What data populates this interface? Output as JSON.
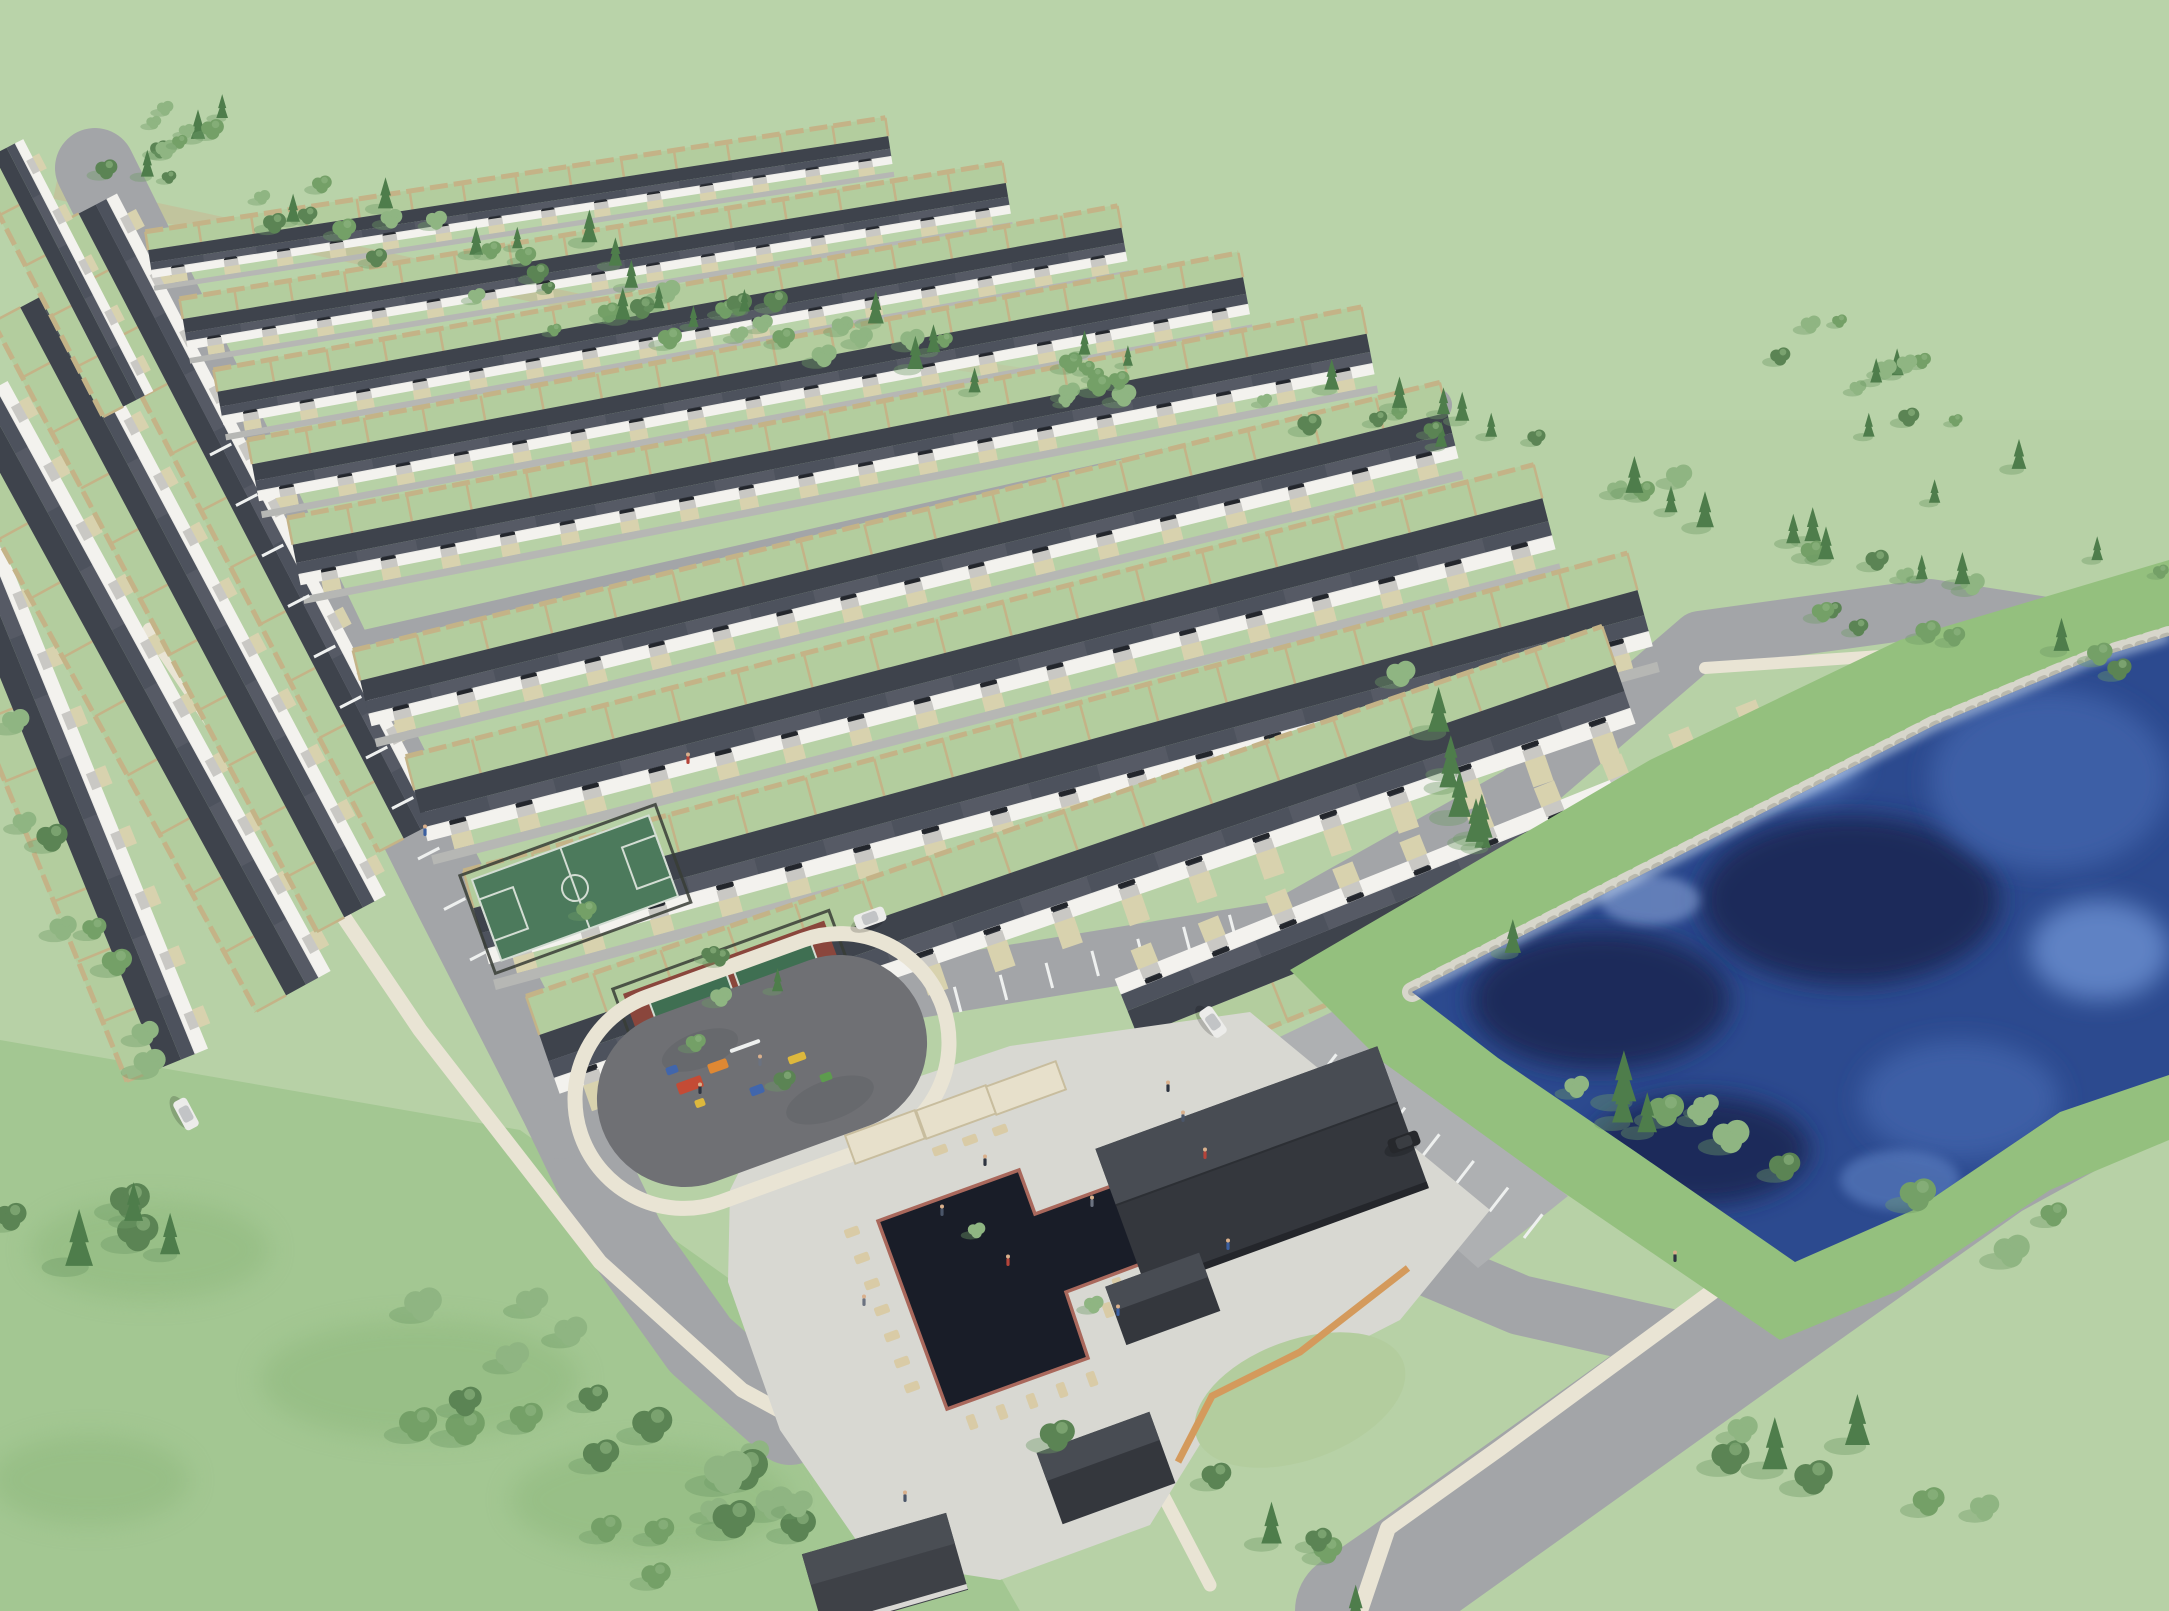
{
  "meta": {
    "description": "Aerial 3D architectural rendering of a planned townhome community with rows of dark-roofed townhouses, detached garage rows, an amenity core (sport court, pickleball court, playground, swimming pool, clubhouse, parking), a deep blue retention pond, perimeter roads, tree lines and open meadows",
    "visible_text": "none"
  },
  "colors": {
    "field": "#b7d1a6",
    "fieldFar": "#bcd5ab",
    "meadow": "#a3c792",
    "meadowShadow": "#8db77c",
    "yard": "#b3cd9e",
    "dirt": "#c8b894",
    "treeDark": "#5b8454",
    "treeMid": "#74a067",
    "treeLight": "#8fb582",
    "pine": "#4e7d4b",
    "treeShadow": "#6f9a66",
    "roof": "#4d525d",
    "roofDark": "#3e434c",
    "wall": "#f3f2ee",
    "window": "#2e323a",
    "garageDoor": "#c9c8c4",
    "road": "#a3a5a8",
    "roadL": "#aeb0b2",
    "lane": "#b6b7b4",
    "stripe": "#eef0ef",
    "walk": "#e9e4d4",
    "driveway": "#d8d2ae",
    "fence": "#c4b387",
    "pondGrass": "#94c07e",
    "pondDeep": "#2c4a8f",
    "pondDark": "#1b2c5a",
    "pondMid": "#3c5ea6",
    "pondLight": "#5f82c4",
    "pondPale": "#8fa9da",
    "rock": "#d7d6cb",
    "rockDark": "#b9b8ad",
    "pool": "#191d28",
    "coping": "#a9685c",
    "plaza": "#d8d8d2",
    "chair": "#d9cba6",
    "pergola": "#e7e0cb",
    "clubRoof": "#34373d",
    "clubRoofLight": "#484c53",
    "orangeFence": "#d49a5c",
    "courtGreen": "#4c7a5c",
    "courtLine": "#d3ddd3",
    "pickleMaroon": "#8a463c",
    "pickleGreen": "#3f6f52",
    "playSurface": "#6f7074",
    "playRed": "#c44b35",
    "playOrange": "#df8833",
    "playYellow": "#ddb83d",
    "playBlue": "#4166ac",
    "playGreen": "#5d9b4e",
    "carWhite": "#ececea",
    "carBlack": "#26282c"
  },
  "scene": {
    "housing_rows": [
      [
        150,
        262,
        890,
        148,
        30
      ],
      [
        185,
        332,
        1008,
        196,
        33
      ],
      [
        220,
        406,
        1124,
        242,
        36
      ],
      [
        255,
        480,
        1246,
        293,
        40
      ],
      [
        296,
        562,
        1370,
        351,
        44
      ],
      [
        365,
        700,
        1452,
        432,
        50
      ],
      [
        420,
        812,
        1548,
        520,
        56
      ],
      [
        480,
        932,
        1644,
        614,
        62
      ],
      [
        548,
        1060,
        1624,
        690,
        66
      ]
    ],
    "lakeside_rows": [
      [
        1128,
        1012,
        1800,
        742,
        66,
        -1
      ]
    ],
    "garage_rows": [
      [
        -40,
        520,
        180,
        1060,
        56,
        -1
      ],
      [
        -18,
        395,
        305,
        985,
        54,
        -1
      ],
      [
        38,
        298,
        362,
        908,
        50,
        -1
      ],
      [
        95,
        205,
        420,
        830,
        46,
        -1
      ],
      [
        6,
        148,
        136,
        400,
        36,
        -1
      ]
    ],
    "tree_bands": [
      {
        "x1": 40,
        "y1": 120,
        "x2": 600,
        "y2": 300,
        "spread": 150,
        "count": 32,
        "s1": 0.45,
        "s2": 0.8,
        "pine": 0.25
      },
      {
        "x1": 600,
        "y1": 300,
        "x2": 1440,
        "y2": 428,
        "spread": 90,
        "count": 40,
        "s1": 0.5,
        "s2": 0.85,
        "pine": 0.3
      },
      {
        "x1": 1440,
        "y1": 428,
        "x2": 1980,
        "y2": 600,
        "spread": 70,
        "count": 22,
        "s1": 0.55,
        "s2": 0.9,
        "pine": 0.35
      },
      {
        "x1": 1800,
        "y1": 330,
        "x2": 2140,
        "y2": 560,
        "spread": 160,
        "count": 16,
        "s1": 0.45,
        "s2": 0.75,
        "pine": 0.3
      },
      {
        "x1": 1405,
        "y1": 650,
        "x2": 1560,
        "y2": 1030,
        "spread": 36,
        "count": 9,
        "s1": 0.8,
        "s2": 1.15,
        "pine": 0.8
      },
      {
        "x1": 1660,
        "y1": 598,
        "x2": 2150,
        "y2": 668,
        "spread": 40,
        "count": 8,
        "s1": 0.6,
        "s2": 0.95,
        "pine": 0.25
      },
      {
        "x1": 1590,
        "y1": 1090,
        "x2": 2070,
        "y2": 1245,
        "spread": 90,
        "count": 12,
        "s1": 0.8,
        "s2": 1.3,
        "pine": 0.3
      },
      {
        "x1": 40,
        "y1": 1140,
        "x2": 840,
        "y2": 1560,
        "spread": 230,
        "count": 28,
        "s1": 0.9,
        "s2": 1.6,
        "pine": 0.12
      },
      {
        "x1": 5,
        "y1": 700,
        "x2": 150,
        "y2": 1090,
        "spread": 70,
        "count": 8,
        "s1": 0.7,
        "s2": 1.1,
        "pine": 0.2
      },
      {
        "x1": 1060,
        "y1": 1400,
        "x2": 1380,
        "y2": 1595,
        "spread": 90,
        "count": 6,
        "s1": 0.8,
        "s2": 1.2,
        "pine": 0.2
      },
      {
        "x1": 1720,
        "y1": 1420,
        "x2": 2150,
        "y2": 1600,
        "spread": 110,
        "count": 7,
        "s1": 0.8,
        "s2": 1.3,
        "pine": 0.15
      },
      {
        "x1": 600,
        "y1": 890,
        "x2": 1120,
        "y2": 1330,
        "spread": 150,
        "count": 9,
        "s1": 0.5,
        "s2": 0.8,
        "pine": 0.1
      }
    ],
    "stripe_runs": [
      {
        "x1": 640,
        "y1": 1096,
        "x2": 1236,
        "y2": 940,
        "n": 13,
        "len": 26
      },
      {
        "x1": 210,
        "y1": 455,
        "x2": 470,
        "y2": 960,
        "n": 10,
        "len": 24
      },
      {
        "x1": 1318,
        "y1": 1078,
        "x2": 1524,
        "y2": 1238,
        "n": 6,
        "len": 30
      }
    ],
    "cars": [
      {
        "x": 870,
        "y": 918,
        "a": -20,
        "c": "white"
      },
      {
        "x": 186,
        "y": 1114,
        "a": 62,
        "c": "white"
      },
      {
        "x": 1213,
        "y": 1022,
        "a": 55,
        "c": "white"
      },
      {
        "x": 1404,
        "y": 1142,
        "a": -20,
        "c": "black"
      }
    ],
    "people": [
      [
        1168,
        1088
      ],
      [
        1183,
        1118
      ],
      [
        1205,
        1155
      ],
      [
        1228,
        1246
      ],
      [
        1092,
        1203
      ],
      [
        985,
        1162
      ],
      [
        942,
        1212
      ],
      [
        1008,
        1262
      ],
      [
        1118,
        1312
      ],
      [
        864,
        1302
      ],
      [
        1675,
        1258
      ],
      [
        905,
        1498
      ],
      [
        688,
        760
      ],
      [
        425,
        832
      ],
      [
        760,
        1062
      ],
      [
        700,
        1090
      ]
    ],
    "chairs": [
      [
        852,
        1232,
        70
      ],
      [
        862,
        1258,
        70
      ],
      [
        872,
        1284,
        70
      ],
      [
        882,
        1310,
        70
      ],
      [
        892,
        1336,
        70
      ],
      [
        902,
        1362,
        70
      ],
      [
        912,
        1387,
        70
      ],
      [
        972,
        1422,
        -20
      ],
      [
        1002,
        1412,
        -20
      ],
      [
        1032,
        1401,
        -20
      ],
      [
        1062,
        1390,
        -20
      ],
      [
        1092,
        1379,
        -20
      ],
      [
        1108,
        1310,
        160
      ],
      [
        1118,
        1285,
        160
      ],
      [
        940,
        1150,
        -110
      ],
      [
        970,
        1140,
        -110
      ],
      [
        1000,
        1130,
        -110
      ]
    ],
    "pergolas": [
      [
        885,
        1137,
        74,
        30,
        -20
      ],
      [
        956,
        1112,
        74,
        30,
        -20
      ],
      [
        1026,
        1088,
        74,
        30,
        -20
      ]
    ],
    "play_items": [
      [
        690,
        1085,
        26,
        12,
        "playRed"
      ],
      [
        718,
        1066,
        20,
        10,
        "playOrange"
      ],
      [
        757,
        1090,
        14,
        9,
        "playBlue"
      ],
      [
        797,
        1058,
        18,
        8,
        "playYellow"
      ],
      [
        826,
        1077,
        12,
        8,
        "playGreen"
      ],
      [
        745,
        1046,
        32,
        4,
        "stripe"
      ],
      [
        700,
        1103,
        10,
        8,
        "playYellow"
      ],
      [
        672,
        1070,
        12,
        8,
        "playBlue"
      ]
    ],
    "counts": {
      "housing_rows": 9,
      "lakeside_rows": 1,
      "garage_rows": 5,
      "sport_courts": 2,
      "pools": 1,
      "ponds": 1,
      "clubhouses": 1,
      "visible_cars": 4
    }
  }
}
